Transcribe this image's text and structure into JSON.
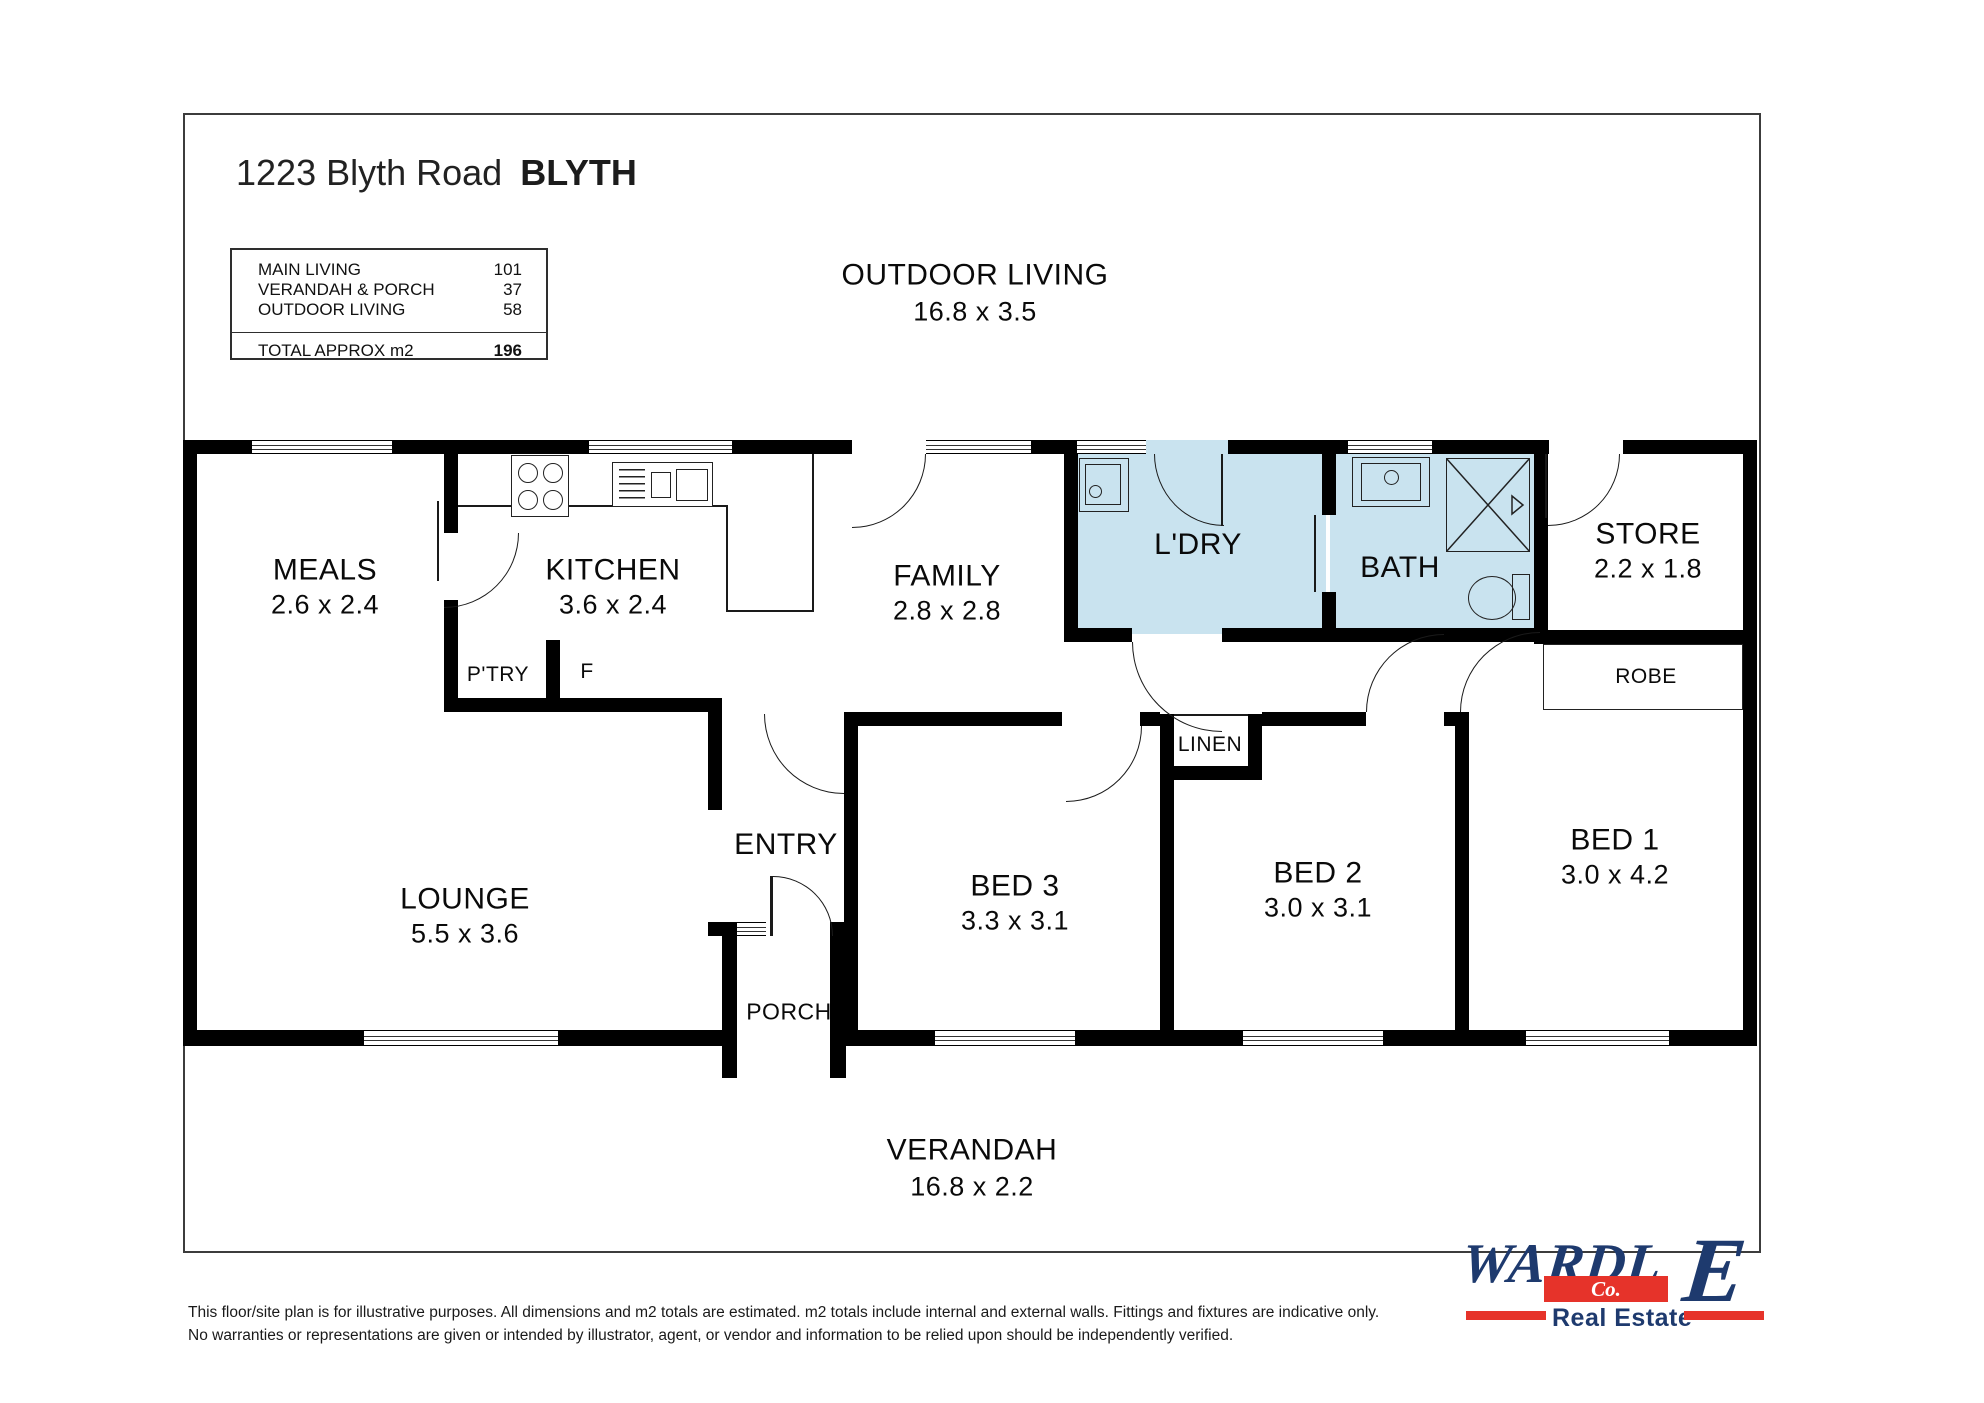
{
  "title": {
    "address": "1223 Blyth Road",
    "suburb": "BLYTH"
  },
  "legend": {
    "rows": [
      {
        "label": "MAIN LIVING",
        "value": "101"
      },
      {
        "label": "VERANDAH & PORCH",
        "value": "37"
      },
      {
        "label": "OUTDOOR LIVING",
        "value": "58"
      }
    ],
    "total_label": "TOTAL APPROX m2",
    "total_value": "196"
  },
  "areas": {
    "outdoor_living": {
      "name": "OUTDOOR LIVING",
      "dims": "16.8 x 3.5"
    },
    "verandah": {
      "name": "VERANDAH",
      "dims": "16.8 x 2.2"
    },
    "meals": {
      "name": "MEALS",
      "dims": "2.6 x 2.4"
    },
    "kitchen": {
      "name": "KITCHEN",
      "dims": "3.6 x 2.4"
    },
    "family": {
      "name": "FAMILY",
      "dims": "2.8 x 2.8"
    },
    "ldry": {
      "name": "L'DRY"
    },
    "bath": {
      "name": "BATH"
    },
    "store": {
      "name": "STORE",
      "dims": "2.2 x 1.8"
    },
    "robe": {
      "name": "ROBE"
    },
    "linen": {
      "name": "LINEN"
    },
    "lounge": {
      "name": "LOUNGE",
      "dims": "5.5 x 3.6"
    },
    "entry": {
      "name": "ENTRY"
    },
    "porch": {
      "name": "PORCH"
    },
    "pantry": {
      "name": "P'TRY"
    },
    "fridge": {
      "name": "F"
    },
    "bed1": {
      "name": "BED 1",
      "dims": "3.0 x 4.2"
    },
    "bed2": {
      "name": "BED 2",
      "dims": "3.0 x 3.1"
    },
    "bed3": {
      "name": "BED 3",
      "dims": "3.3 x 3.1"
    }
  },
  "disclaimer": {
    "line1": "This floor/site plan is for illustrative purposes. All dimensions and m2 totals are estimated. m2 totals include internal and external walls. Fittings and fixtures are indicative only.",
    "line2": "No warranties or representations are given or intended by illustrator, agent, or vendor and information to be relied upon should be independently verified."
  },
  "logo": {
    "brand": "WARDL",
    "brand_last": "E",
    "co": "Co.",
    "tagline": "Real Estate"
  },
  "colors": {
    "wet_area": "#c9e3ef",
    "logo_navy": "#1e3a6e",
    "logo_red": "#e6332a"
  }
}
